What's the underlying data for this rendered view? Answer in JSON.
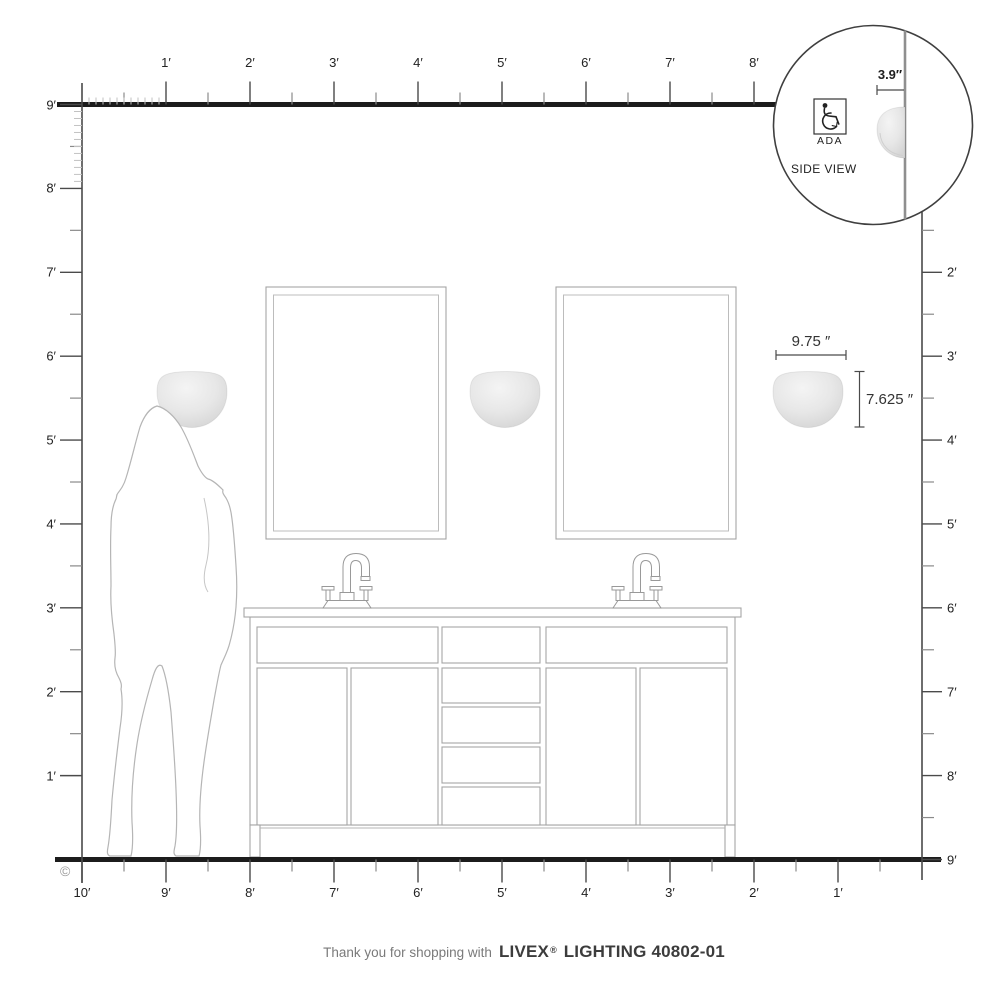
{
  "rulers": {
    "top": {
      "labels": [
        "1′",
        "2′",
        "3′",
        "4′",
        "5′",
        "6′",
        "7′",
        "8′"
      ]
    },
    "left": {
      "labels": [
        "9′",
        "8′",
        "7′",
        "6′",
        "5′",
        "4′",
        "3′",
        "2′",
        "1′"
      ]
    },
    "right": {
      "labels": [
        "2′",
        "3′",
        "4′",
        "5′",
        "6′",
        "7′",
        "8′",
        "9′"
      ]
    },
    "bottom": {
      "labels": [
        "10′",
        "9′",
        "8′",
        "7′",
        "6′",
        "5′",
        "4′",
        "3′",
        "2′",
        "1′"
      ]
    }
  },
  "dimensions": {
    "sconce_width": "9.75 ″",
    "sconce_height": "7.625 ″",
    "sconce_depth": "3.9″"
  },
  "inset": {
    "ada_label": "ADA",
    "view_label": "SIDE VIEW"
  },
  "footer": {
    "prefix": "Thank you for shopping with",
    "brand": "LIVEX",
    "registered": "®",
    "model": "LIGHTING 40802-01"
  },
  "copyright_symbol": "©",
  "colors": {
    "line_dark": "#1c1c1c",
    "ruler": "#4a4a4a",
    "tick_half": "#8a8a8a",
    "tick_inch": "#c2c2c2",
    "outline": "#a5a5a5",
    "dim": "#4a4a4a",
    "text": "#222222",
    "footer_muted": "#7a7a7a",
    "footer_bold": "#3c3c3c"
  }
}
